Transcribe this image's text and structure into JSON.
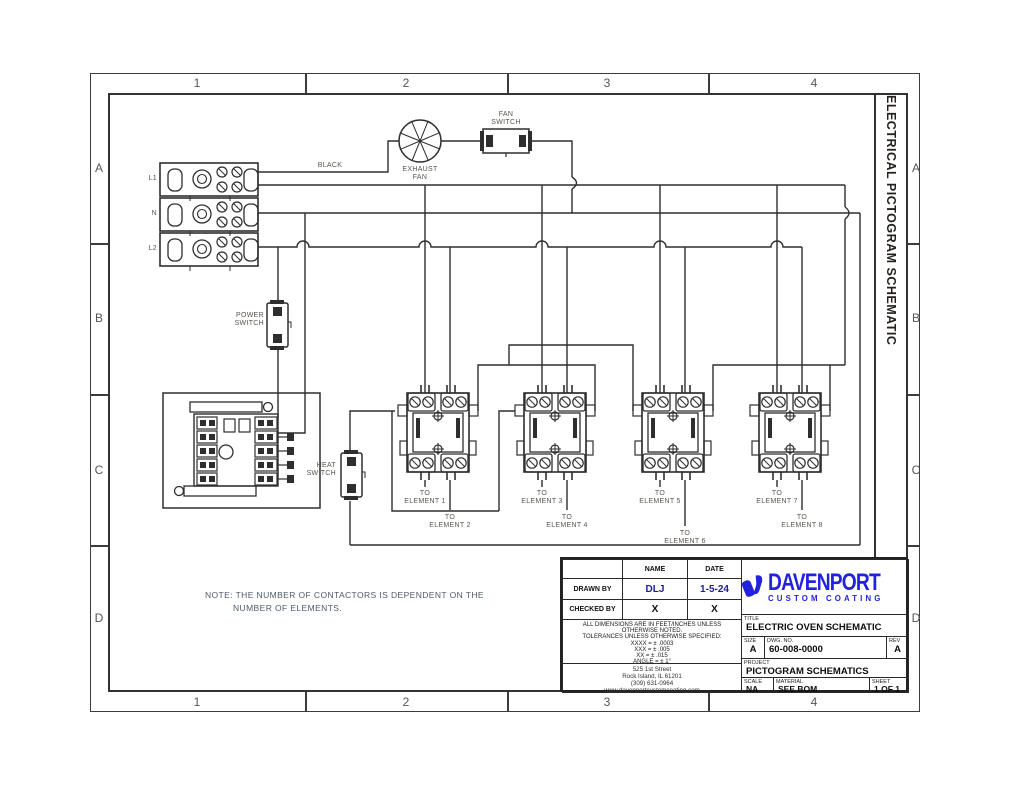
{
  "sheet": {
    "zone_cols": [
      "1",
      "2",
      "3",
      "4"
    ],
    "zone_rows": [
      "A",
      "B",
      "C",
      "D"
    ],
    "side_title": "ELECTRICAL PICTOGRAM SCHEMATIC"
  },
  "schematic": {
    "labels": {
      "black_wire": "BLACK",
      "fan_switch": "FAN\nSWITCH",
      "exhaust_fan": "EXHAUST\nFAN",
      "power_switch": "POWER\nSWITCH",
      "heat_switch": "HEAT\nSWITCH",
      "terminals": [
        "L1",
        "N",
        "L2"
      ],
      "note_line1": "NOTE: THE NUMBER OF CONTACTORS IS DEPENDENT ON THE",
      "note_line2": "NUMBER OF ELEMENTS.",
      "elements": [
        "TO\nELEMENT 1",
        "TO\nELEMENT 2",
        "TO\nELEMENT 3",
        "TO\nELEMENT 4",
        "TO\nELEMENT 5",
        "TO\nELEMENT 6",
        "TO\nELEMENT 7",
        "TO\nELEMENT 8"
      ]
    }
  },
  "title_block": {
    "header": {
      "name": "NAME",
      "date": "DATE"
    },
    "drawn_by": {
      "label": "DRAWN BY",
      "name": "DLJ",
      "date": "1-5-24"
    },
    "checked_by": {
      "label": "CHECKED BY",
      "name": "X",
      "date": "X"
    },
    "tolerances": {
      "line1": "ALL DIMENSIONS ARE IN FEET/INCHES UNLESS",
      "line2": "OTHERWISE NOTED.",
      "line3": "TOLERANCES UNLESS OTHERWISE SPECIFIED:",
      "line4": "XXXX = ± .0003",
      "line5": "XXX = ± .005",
      "line6": "XX = ± .015",
      "line7": "ANGLE = ± 1°"
    },
    "address": {
      "line1": "525 1st Street",
      "line2": "Rock Island, IL 61201",
      "line3": "(309) 631-0964",
      "line4": "www.davenportcustomcoating.com"
    },
    "logo": {
      "name": "DAVENPORT",
      "tagline": "CUSTOM COATING"
    },
    "title": {
      "label": "TITLE",
      "value": "ELECTRIC OVEN SCHEMATIC"
    },
    "size": {
      "label": "SIZE",
      "value": "A"
    },
    "dwg": {
      "label": "DWG. NO.",
      "value": "60-008-0000"
    },
    "rev": {
      "label": "REV",
      "value": "A"
    },
    "project": {
      "label": "PROJECT",
      "value": "PICTOGRAM SCHEMATICS"
    },
    "scale": {
      "label": "SCALE",
      "value": "NA"
    },
    "material": {
      "label": "MATERIAL",
      "value": "SEE BOM"
    },
    "sheet_num": {
      "label": "SHEET",
      "value": "1 OF 1"
    }
  },
  "colors": {
    "line": "#2e2e2e",
    "logo_blue": "#2222dd",
    "value_blue": "#1c1c9c"
  }
}
